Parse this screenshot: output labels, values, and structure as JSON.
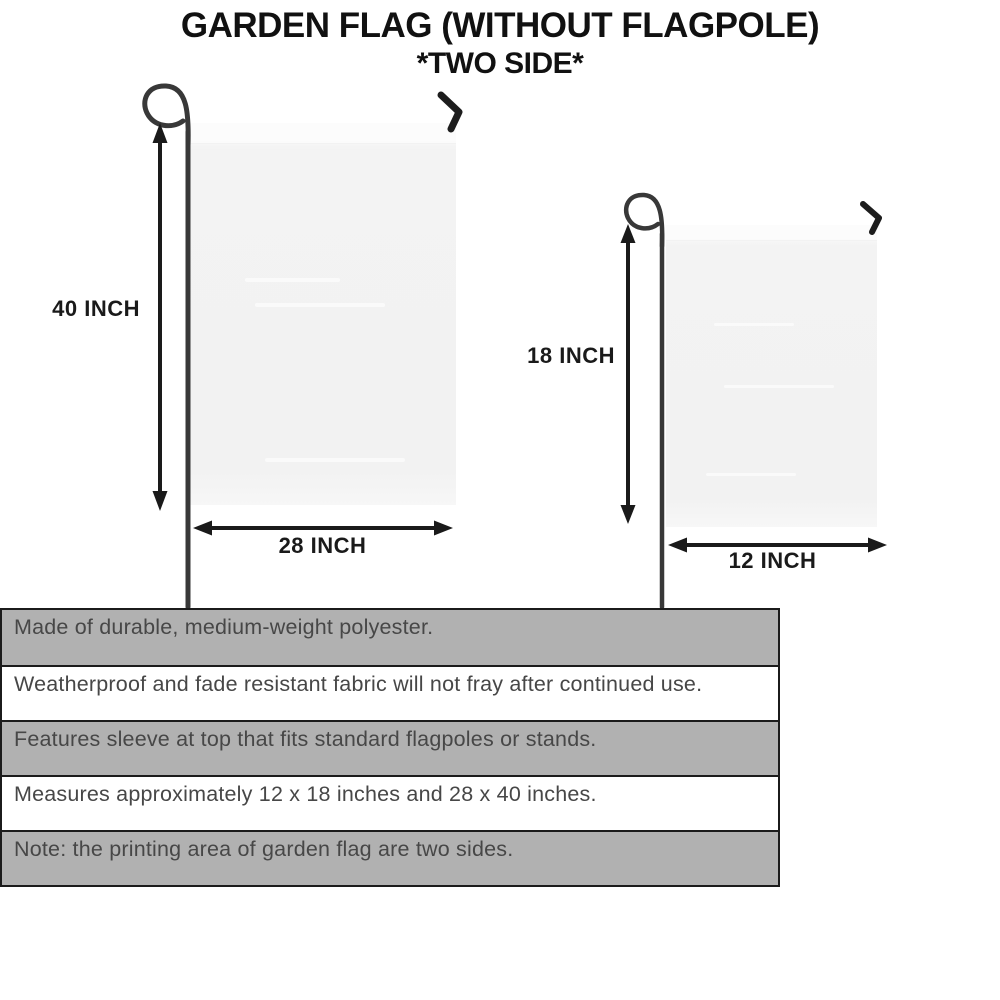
{
  "title": {
    "line1": "GARDEN FLAG (WITHOUT FLAGPOLE)",
    "line2": "*TWO SIDE*"
  },
  "large_flag": {
    "height_label": "40 INCH",
    "width_label": "28 INCH"
  },
  "small_flag": {
    "height_label": "18 INCH",
    "width_label": "12 INCH"
  },
  "features": [
    "Made of durable, medium-weight polyester.",
    "Weatherproof and fade resistant fabric will not fray after continued use.",
    "Features sleeve at top that fits standard flagpoles or stands.",
    "Measures approximately 12 x 18 inches and 28 x 40 inches.",
    "Note: the printing area of garden flag are two sides."
  ],
  "colors": {
    "stripe_gray": "#b1b1b1",
    "stripe_white": "#ffffff",
    "stripe_border": "#1b1b1b",
    "flag_fill": "#f2f2f2",
    "pole": "#383838",
    "arrow": "#1a1a1a",
    "feature_text": "#474747",
    "title_text": "#111111"
  }
}
